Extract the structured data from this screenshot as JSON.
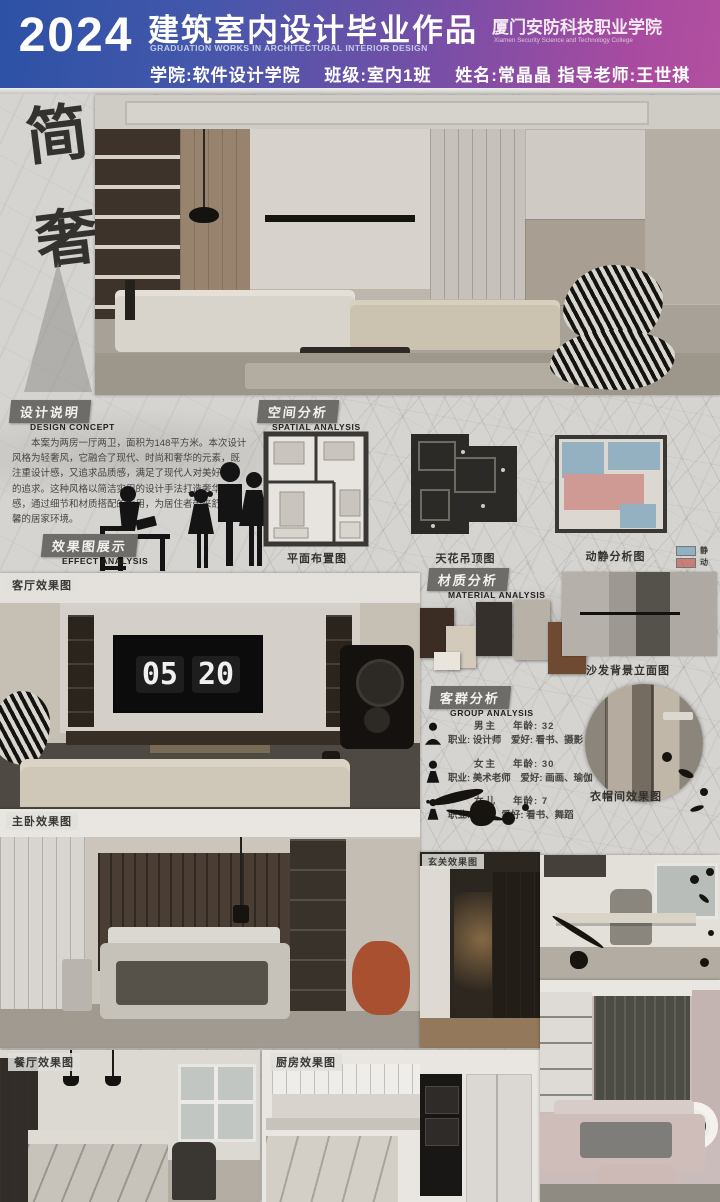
{
  "header": {
    "year": "2024",
    "title_cn": "建筑室内设计毕业作品",
    "title_en": "GRADUATION WORKS IN ARCHITECTURAL INTERIOR DESIGN",
    "school_cn": "厦门安防科技职业学院",
    "school_en": "Xiamen Security Science and Technology College",
    "info_line": "学院:软件设计学院　 班级:室内1班　 姓名:常晶晶  指导老师:王世祺"
  },
  "calligraphy": {
    "text": "简奢"
  },
  "design_concept": {
    "label_cn": "设计说明",
    "label_en": "DESIGN CONCEPT",
    "body": "本案为两房一厅两卫，面积为148平方米。本次设计风格为轻奢风，它融合了现代、时尚和奢华的元素，既注重设计感，又追求品质感，满足了现代人对美好生活的追求。这种风格以简洁实用的设计手法打造奢华质感，通过细节和材质搭配的运用，为居住者带来舒适温馨的居家环境。"
  },
  "spatial": {
    "label_cn": "空间分析",
    "label_en": "SPATIAL ANALYSIS",
    "plan1_caption": "平面布置图",
    "plan2_caption": "天花吊顶图",
    "plan3_caption": "动静分析图",
    "legend_static": "静",
    "legend_dynamic": "动",
    "legend_static_color": "#8fb2c2",
    "legend_dynamic_color": "#c97f78"
  },
  "effect": {
    "label_cn": "效果图展示",
    "label_en": "EFFECT ANALYSIS"
  },
  "material": {
    "label_cn": "材质分析",
    "label_en": "MATERIAL ANALYSIS",
    "elevation_caption": "沙发背景立面图"
  },
  "group": {
    "label_cn": "客群分析",
    "label_en": "GROUP ANALYSIS",
    "members": [
      {
        "role": "男主",
        "age": "年龄: 32",
        "job": "职业: 设计师",
        "hobby": "爱好: 看书、摄影"
      },
      {
        "role": "女主",
        "age": "年龄: 30",
        "job": "职业: 美术老师",
        "hobby": "爱好: 画画、瑜伽"
      },
      {
        "role": "女儿",
        "age": "年龄: 7",
        "job": "职业: 学生",
        "hobby": "爱好: 看书、舞蹈"
      }
    ]
  },
  "renders": {
    "living": {
      "caption": "客厅效果图",
      "clock_h": "05",
      "clock_m": "20"
    },
    "master": {
      "caption": "主卧效果图"
    },
    "entry": {
      "caption": "玄关效果图"
    },
    "wardrobe": {
      "caption": "衣帽间效果图"
    },
    "dining": {
      "caption": "餐厅效果图"
    },
    "kitchen": {
      "caption": "厨房效果图"
    }
  }
}
